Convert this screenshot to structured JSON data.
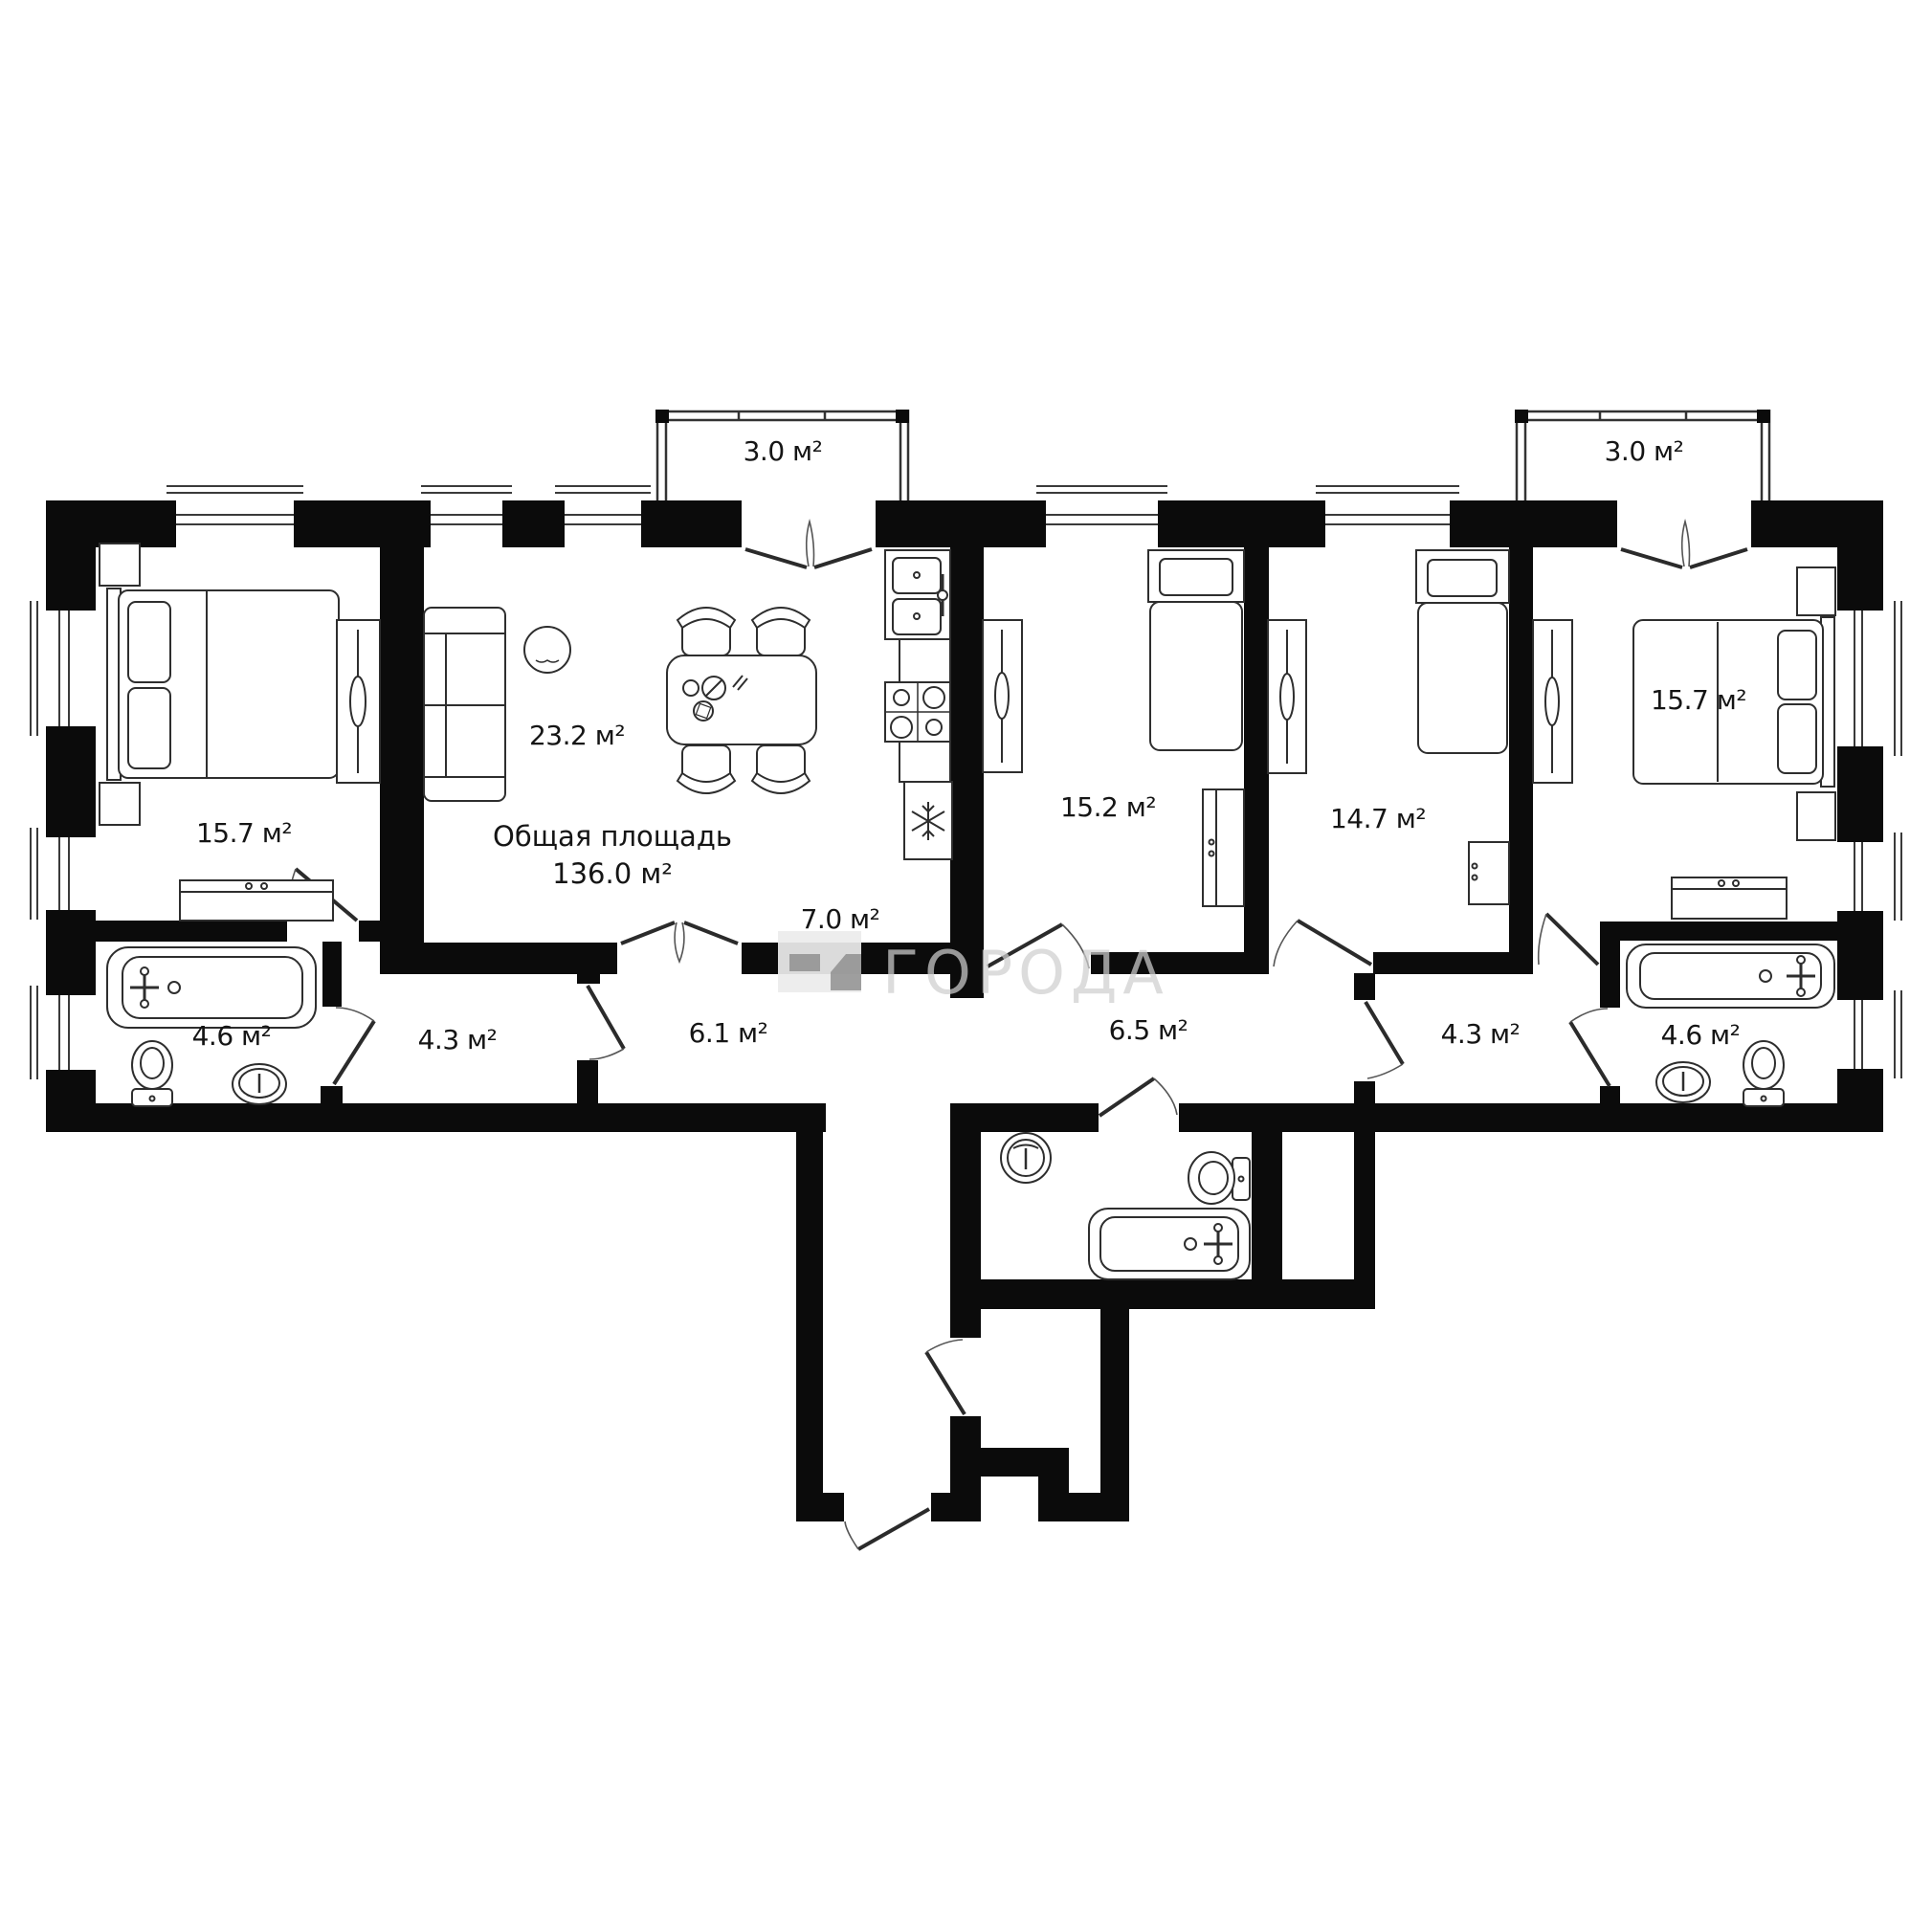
{
  "summary": {
    "label": "Общая площадь",
    "value": "136.0 м²"
  },
  "watermark": {
    "text": "ГОРОДА",
    "icon": "brand-building-icon"
  },
  "rooms": {
    "bedroom_left": "15.7 м²",
    "living": "23.2 м²",
    "kitchen": "7.0 м²",
    "bedroom_2": "15.2 м²",
    "bedroom_3": "14.7 м²",
    "bedroom_right": "15.7 м²",
    "bathroom_left": "4.6 м²",
    "hallway_left": "4.3 м²",
    "corridor_left": "6.1 м²",
    "corridor_right": "6.5 м²",
    "hallway_right": "4.3 м²",
    "bathroom_right": "4.6 м²",
    "balcony_left": "3.0 м²",
    "balcony_right": "3.0 м²"
  },
  "colors": {
    "background": "#ffffff",
    "wall": "#0b0b0b",
    "furniture_stroke": "#2e2e2e",
    "watermark_gray": "#cfcfcf"
  }
}
